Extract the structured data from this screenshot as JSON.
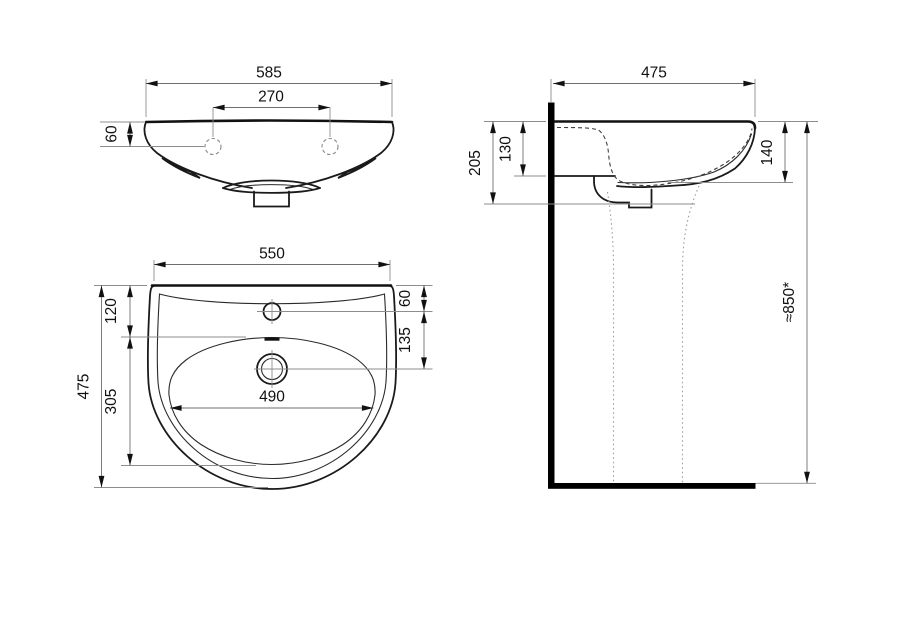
{
  "drawing": {
    "background": "#ffffff",
    "line_color": "#1a1a1a",
    "dim_line_color": "#6e6e6e",
    "front_view": {
      "overall_width": "585",
      "tap_hole_spacing": "270",
      "rim_to_tap_holes": "60"
    },
    "plan_view": {
      "top_width": "550",
      "overall_depth": "475",
      "rim_to_bowl_front": "120",
      "bowl_length": "305",
      "bowl_width": "490",
      "rim_to_tap_hole": "60",
      "tap_hole_to_drain": "135"
    },
    "side_view": {
      "overall_depth": "475",
      "rim_to_trap_bottom": "205",
      "rim_to_basin_back_bottom": "130",
      "rim_to_front_underside": "140",
      "rim_height_from_floor": "≈850*"
    }
  }
}
